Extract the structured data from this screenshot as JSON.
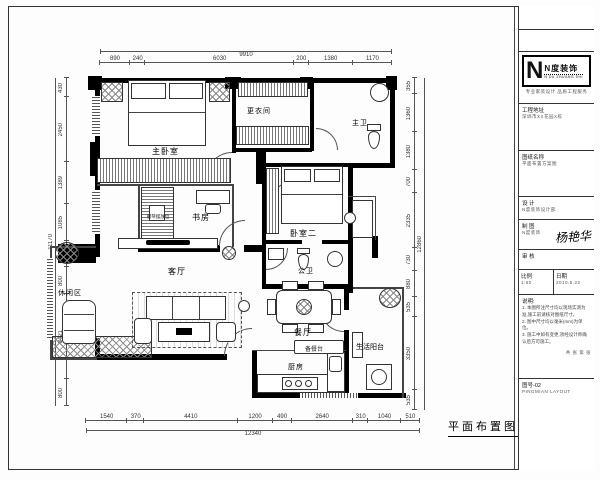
{
  "drawing": {
    "title": "平面布置图"
  },
  "logo": {
    "letter": "N",
    "name": "N度装饰",
    "sub": "N DU ZHUANG SHI",
    "tagline": "专业家装设计  品质工程服务"
  },
  "titleblock": {
    "rows": [
      {
        "label": "工程地址",
        "value": "深圳市XX花园X栋"
      },
      {
        "label": "图纸名称",
        "value": "平面布置方案图"
      },
      {
        "label": "设 计",
        "value": "N度装饰设计部"
      },
      {
        "label": "制 图",
        "value": "N度装饰"
      },
      {
        "label": "审 核",
        "value": ""
      }
    ],
    "signature": "杨艳华",
    "scale_label": "比例",
    "scale_value": "1:60",
    "sheet_label": "共 张  第 张",
    "date_label": "日期",
    "date_value": "2010.5.22",
    "notes_title": "说明:",
    "notes": [
      "1. 本图所注尺寸均以现场实测为准,施工前请核对图纸尺寸。",
      "2. 图中尺寸均以毫米(mm)为单位。",
      "3. 施工中如有变更,须经设计师确认后方可施工。"
    ],
    "footer_line1": "图号-02",
    "footer_line2": "PINGMIAN LAYOUT"
  },
  "labels": {
    "master_bedroom": "主卧室",
    "dressing": "更衣间",
    "master_bath": "主卫",
    "study": "书房",
    "piano": "钢琴摆放位",
    "bedroom2": "卧室二",
    "public_bath": "公卫",
    "living": "客厅",
    "leisure": "休闲区",
    "dining": "餐厅",
    "kitchen": "厨房",
    "balcony": "生活阳台",
    "prep_counter": "备餐台"
  },
  "dims": {
    "top": {
      "total": "9910",
      "segments": [
        890,
        240,
        6030,
        200,
        1380,
        1170
      ]
    },
    "bottom": {
      "total": "12340",
      "segments": [
        1540,
        370,
        4410,
        1200,
        490,
        2640,
        310,
        1040,
        510
      ]
    },
    "left": {
      "total": "11170",
      "segments": [
        430,
        2450,
        1389,
        1085,
        795,
        800,
        3421,
        800
      ]
    },
    "right": {
      "total": "12860",
      "segments": [
        355,
        1360,
        1380,
        700,
        2335,
        730,
        880,
        535,
        3350,
        535
      ]
    }
  }
}
